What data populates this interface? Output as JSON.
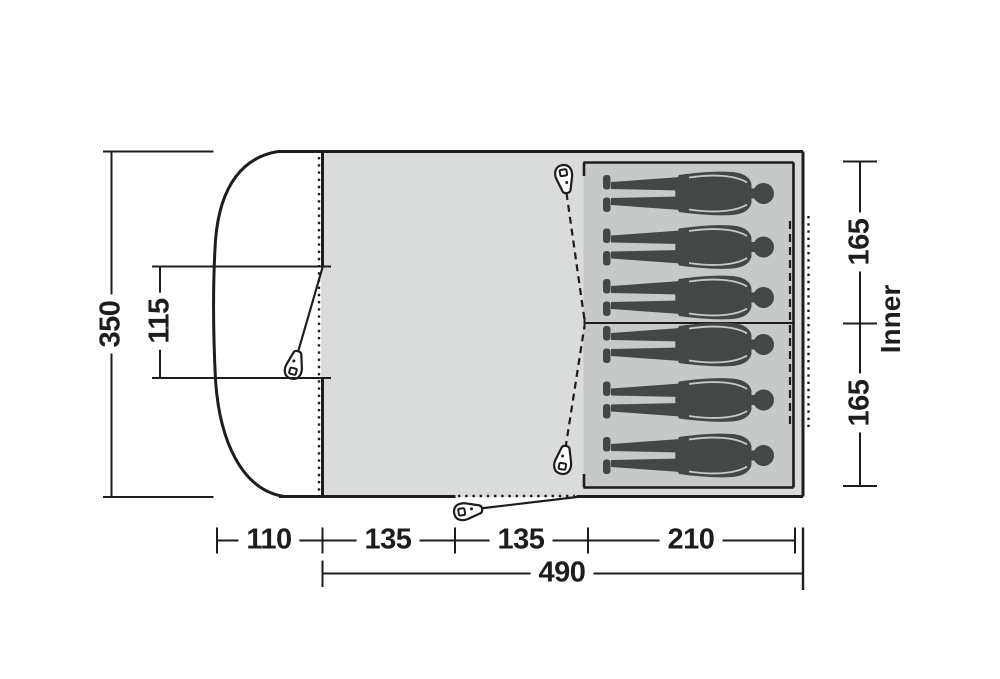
{
  "diagram": {
    "type": "tent floor plan, top view",
    "dimensions": {
      "depth_total": "350",
      "front_door_width": "115",
      "porch_depth": "110",
      "segment_1": "135",
      "segment_2": "135",
      "inner_length": "210",
      "length_total": "490",
      "inner_width_top": "165",
      "inner_width_bottom": "165",
      "inner_label": "Inner"
    },
    "inner_tent": {
      "cabins": 2,
      "sleeping_figures": 6
    },
    "icons": {
      "zipper_pulls": 4
    },
    "colors": {
      "line": "#1d1d1b",
      "body_fill": "#dadbdb",
      "inner_fill": "#c7c9c9",
      "figure_fill": "#454747",
      "background": "#ffffff"
    }
  }
}
